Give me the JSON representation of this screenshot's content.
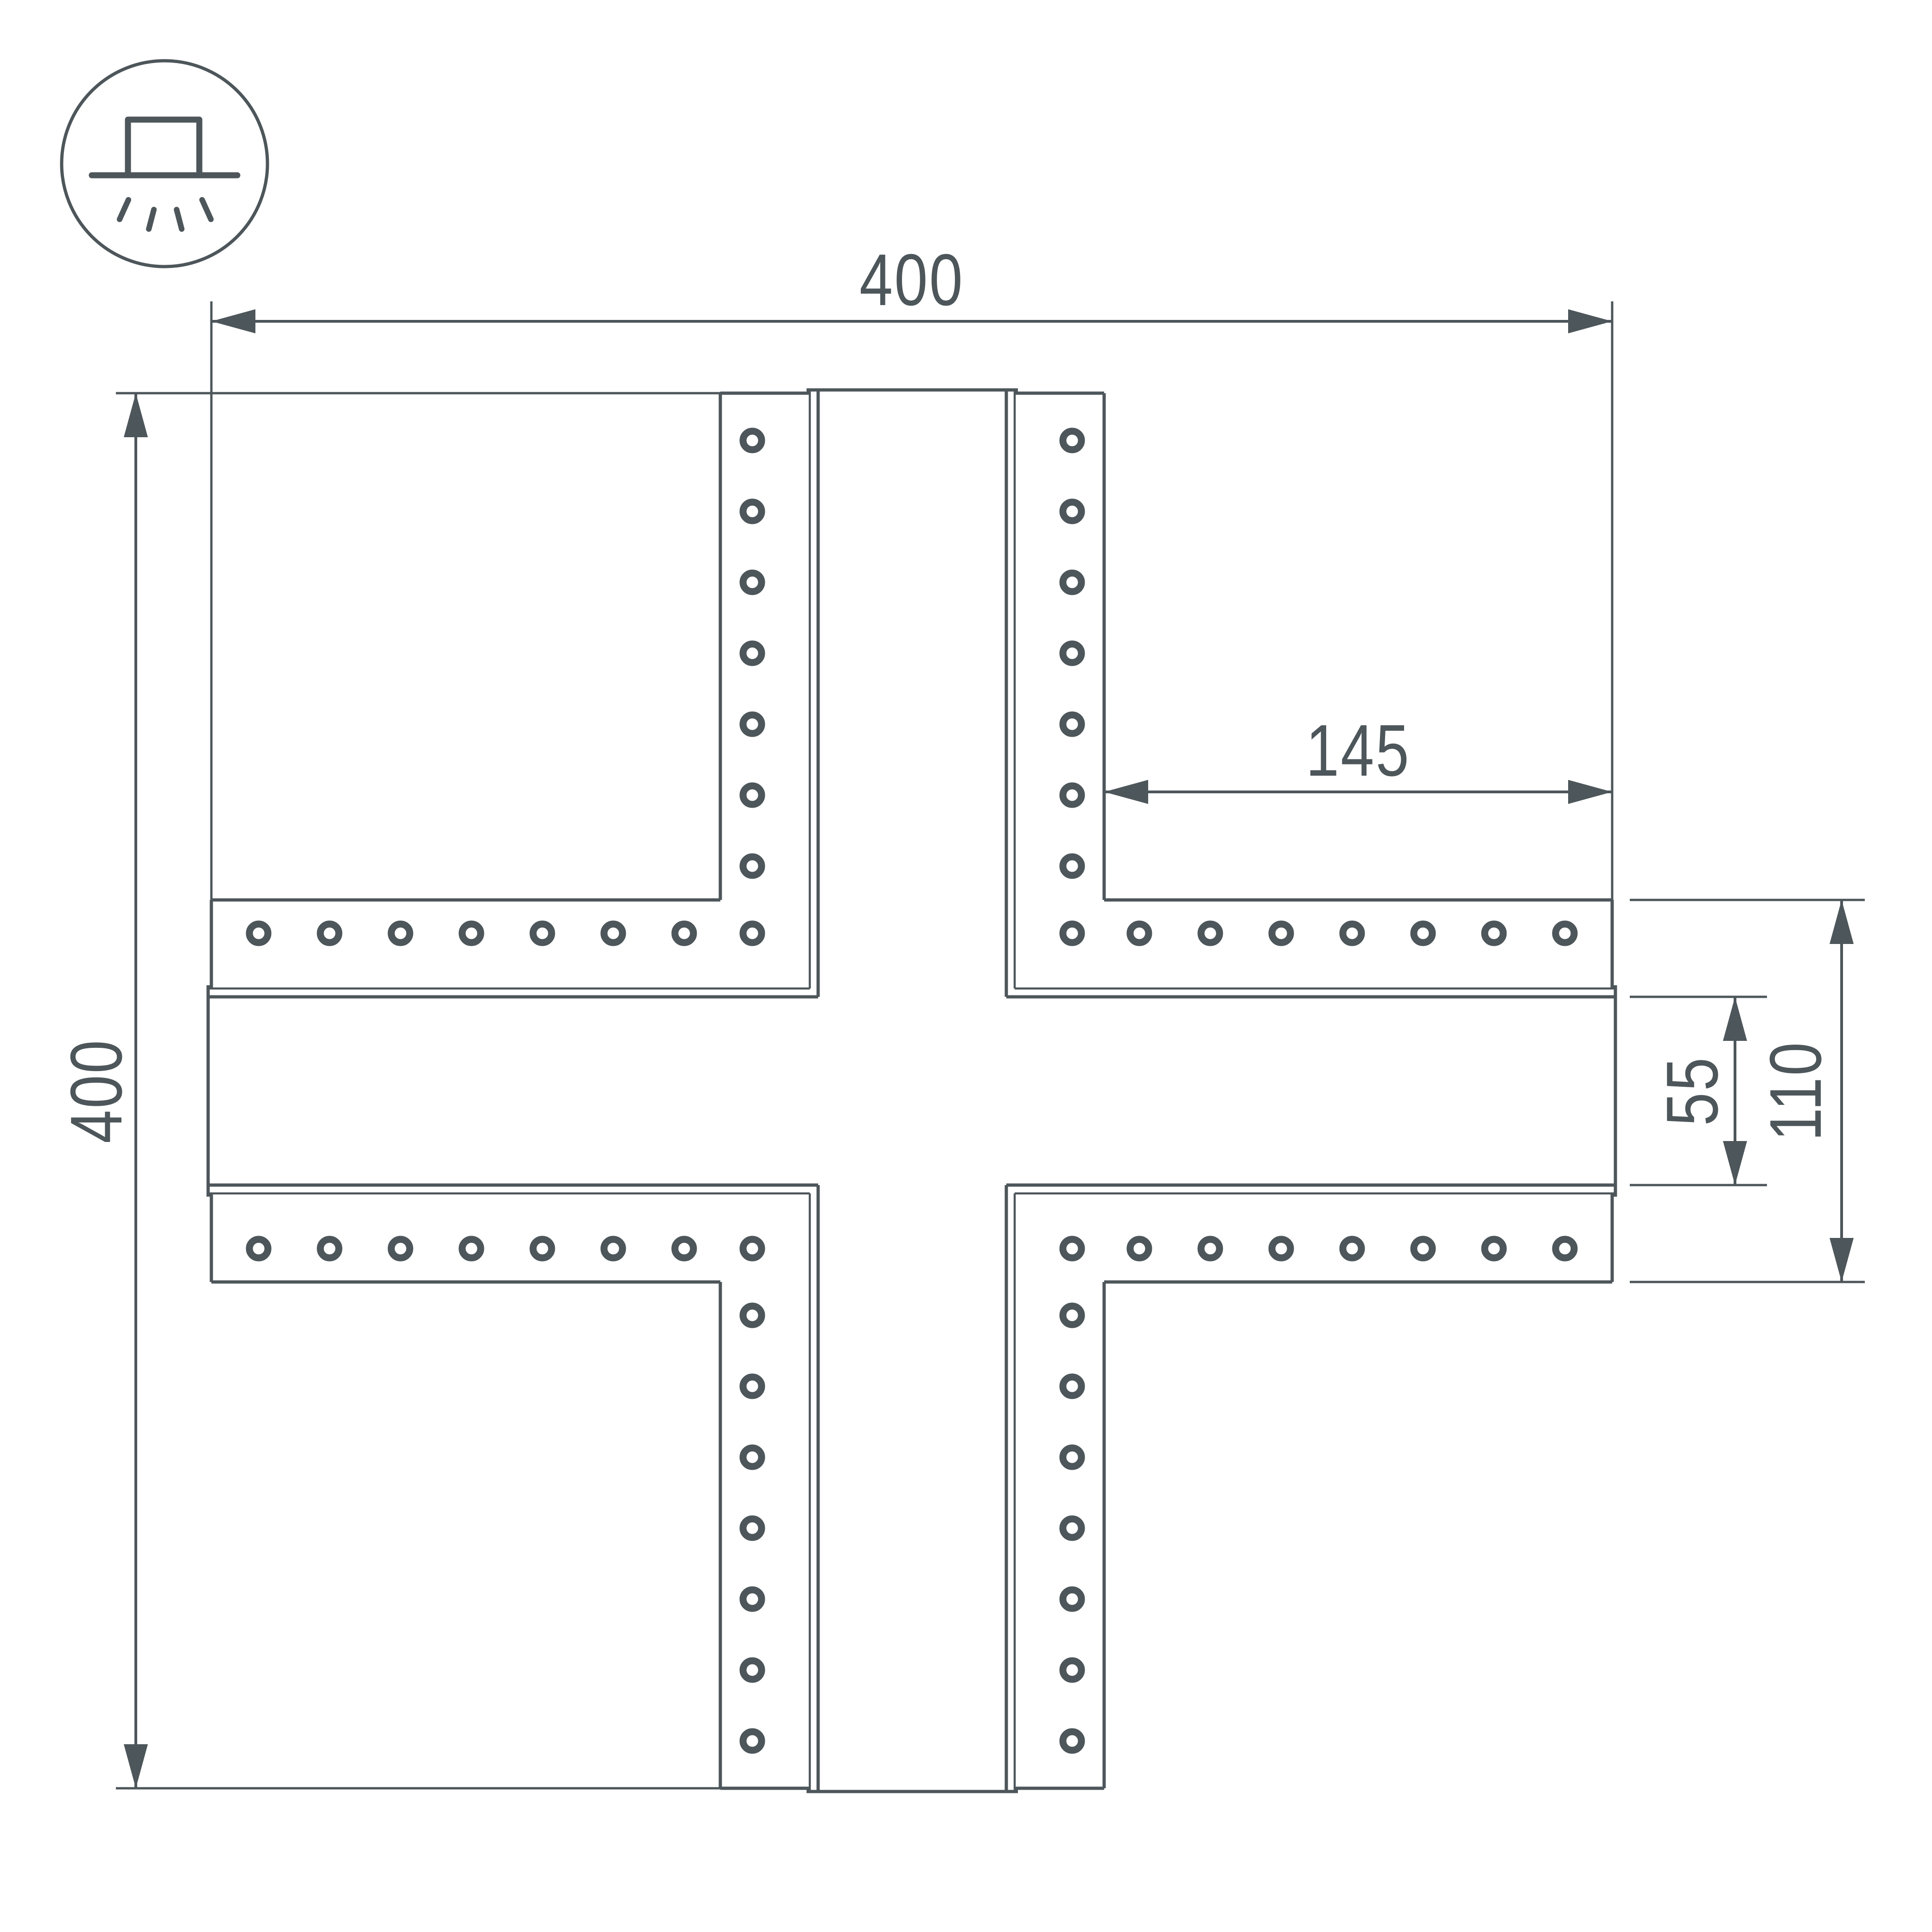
{
  "meta": {
    "background_color": "#ffffff",
    "line_color": "#4d565a",
    "drawing_type": "technical dimension drawing of X-shaped profile connector"
  },
  "icon": {
    "name": "recessed-ceiling-light-icon"
  },
  "dimensions": {
    "overall_width": "400",
    "overall_height": "400",
    "arm_length": "145",
    "slot_width": "55",
    "arm_width": "110"
  }
}
